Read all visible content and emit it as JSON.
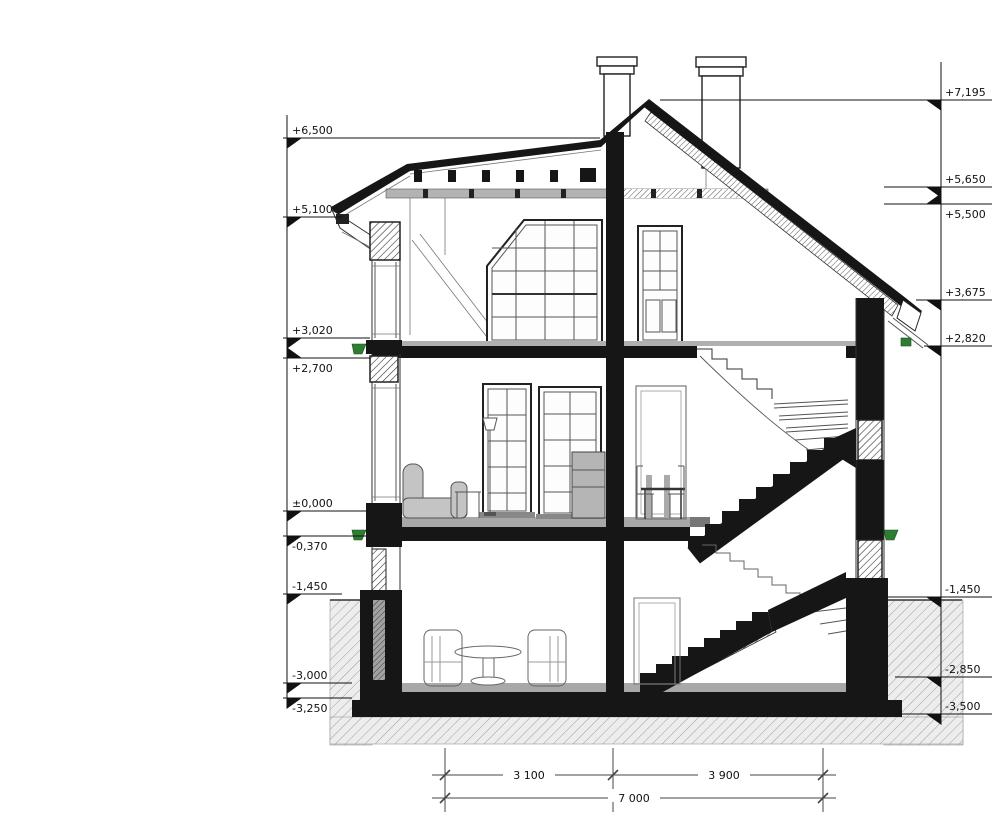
{
  "title": "House cross-section drawing",
  "levels_left": [
    {
      "label": "+6,500"
    },
    {
      "label": "+5,100"
    },
    {
      "label": "+3,020"
    },
    {
      "label": "+2,700"
    },
    {
      "label": "±0,000"
    },
    {
      "label": "-0,370"
    },
    {
      "label": "-1,450"
    },
    {
      "label": "-3,000"
    },
    {
      "label": "-3,250"
    }
  ],
  "levels_right": [
    {
      "label": "+7,195"
    },
    {
      "label": "+5,650"
    },
    {
      "label": "+5,500"
    },
    {
      "label": "+3,675"
    },
    {
      "label": "+2,820"
    },
    {
      "label": "-1,450"
    },
    {
      "label": "-2,850"
    },
    {
      "label": "-3,500"
    }
  ],
  "dimensions": {
    "segment_1": "3 100",
    "segment_2": "3 900",
    "total": "7 000"
  },
  "colors": {
    "ink": "#1a1a1a",
    "slab_gray": "#a8a8a8",
    "furniture_gray": "#c4c4c4",
    "accent_green": "#2e7d32",
    "soil_background": "#ededed"
  }
}
